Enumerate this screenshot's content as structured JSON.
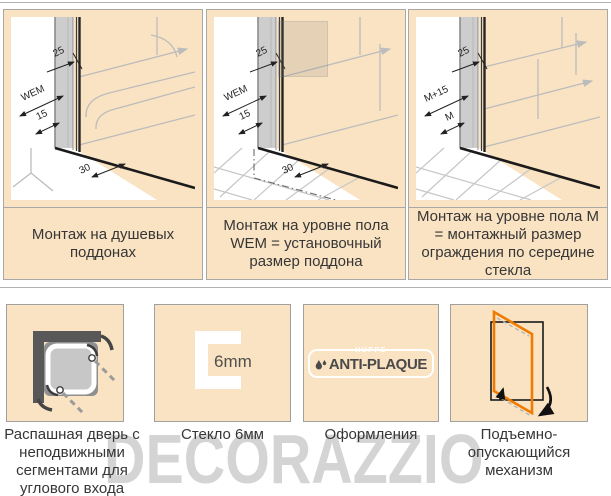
{
  "install_diagrams": [
    {
      "caption": "Монтаж на душевых поддонах",
      "dims": {
        "glass_offset": "25",
        "width_label": "WEM",
        "offset_label": "15",
        "bottom_label": "30"
      }
    },
    {
      "caption": "Монтаж на уровне пола WEM = установочный размер поддона",
      "dims": {
        "glass_offset": "25",
        "width_label": "WEM",
        "offset_label": "15",
        "bottom_label": "30"
      }
    },
    {
      "caption": "Монтаж на уровне пола М = монтажный размер ограждения по середине стекла",
      "dims": {
        "glass_offset": "25",
        "width_label": "M+15",
        "offset_label": "M"
      }
    }
  ],
  "features": [
    {
      "caption": "Распашная дверь с неподвижными сегментами для углового входа"
    },
    {
      "caption": "Стекло 6мм",
      "icon_label": "6mm"
    },
    {
      "caption": "Оформления",
      "logo_brand": "HUPPE",
      "logo_name": "ANTI-PLAQUE"
    },
    {
      "caption": "Подъемно-опускающийся механизм"
    }
  ],
  "watermark": {
    "text": "DECORAZZIO"
  },
  "colors": {
    "panel_bg": "#FAE3C2",
    "border_gray": "#A8A8A8",
    "accent_orange": "#EF7C00",
    "dark_wall_gray": "#585858",
    "watermark_gray": "#D4D4D4"
  }
}
